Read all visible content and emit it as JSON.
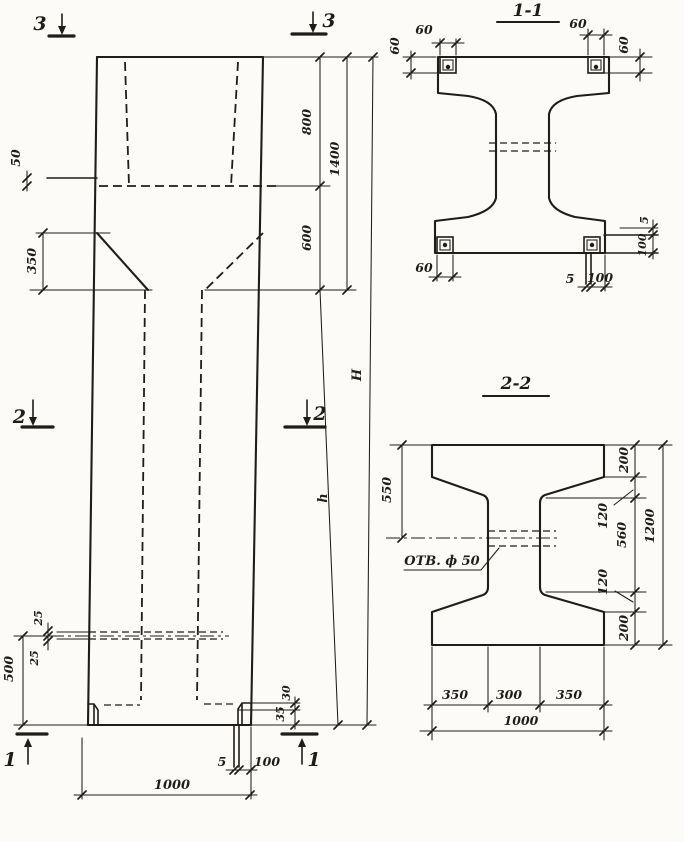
{
  "colors": {
    "paper": "#fcfbf8",
    "ink": "#201d18"
  },
  "elevation": {
    "markers": {
      "top": "3",
      "middle": "2",
      "bottom": "1"
    },
    "dims": {
      "ledge_50": "50",
      "taper_350": "350",
      "top_800": "800",
      "top_total_1400": "1400",
      "taper_600": "600",
      "height_H": "H",
      "shaft_h": "h",
      "hole_25_top": "25",
      "hole_25_bottom": "25",
      "hole_level_500": "500",
      "foot_30": "30",
      "foot_35": "35",
      "foot_gap_5": "5",
      "foot_plate_100": "100",
      "base_width_1000": "1000"
    }
  },
  "section_1_1": {
    "title": "1-1",
    "dims": {
      "top_left_width_60": "60",
      "top_left_height_60": "60",
      "top_right_width_60": "60",
      "top_right_height_60": "60",
      "bottom_left_60": "60",
      "right_gap_5": "5",
      "right_height_100": "100",
      "bottom_gap_5": "5",
      "bottom_width_100": "100"
    }
  },
  "section_2_2": {
    "title": "2-2",
    "hole_label": "ОТВ. ф 50",
    "dims": {
      "flange_550": "550",
      "top_200": "200",
      "upper_120": "120",
      "web_560": "560",
      "lower_120": "120",
      "bottom_200": "200",
      "total_1200": "1200",
      "bottom_350_left": "350",
      "bottom_300": "300",
      "bottom_350_right": "350",
      "bottom_1000": "1000"
    }
  }
}
